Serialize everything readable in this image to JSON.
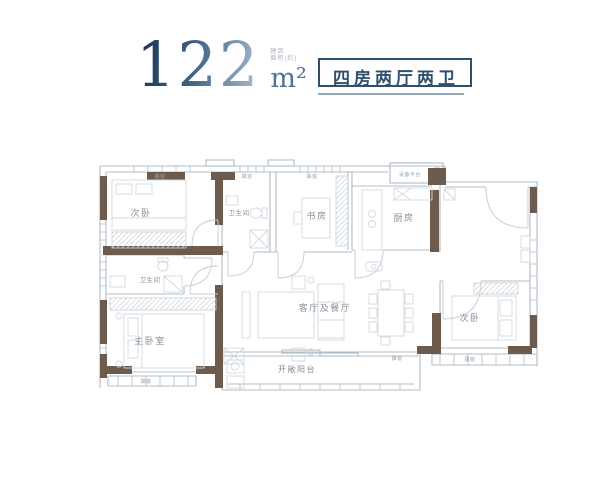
{
  "header": {
    "area_value": "122",
    "area_caption": "建筑\n面积(约)",
    "area_unit": "m²",
    "layout_badge": "四房两厅两卫",
    "accent_color": "#2f4f6e",
    "number_gradient_start": "#16334f",
    "number_gradient_end": "#a9bfd3"
  },
  "floor_plan": {
    "wall_color": "#6d5c4d",
    "line_color": "#b0bcc6",
    "furniture_color": "#d2d9df",
    "label_color": "#878f99",
    "rooms": {
      "bedroom_top_left": "次卧",
      "bathroom_top": "卫生间",
      "study": "书房",
      "kitchen": "厨房",
      "equipment_platform": "设备平台",
      "bathroom_master": "卫生间",
      "master_bedroom": "主卧室",
      "living_dining": "客厅及餐厅",
      "bedroom_bottom_right": "次卧",
      "balcony": "开敞阳台"
    },
    "bay_window_label": "飘窗"
  }
}
